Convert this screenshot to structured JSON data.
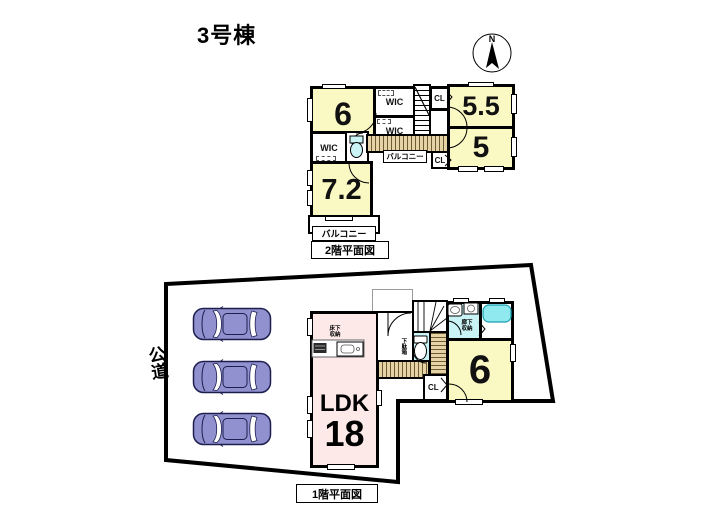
{
  "meta": {
    "title": "3号棟"
  },
  "compass": {
    "north_label": "N"
  },
  "colors": {
    "room-yellow": "#FBF9C3",
    "ldk-pink": "#FCE9E8",
    "water-cyan": "#C9F3F4",
    "tub-cyan": "#8FE9EF",
    "wood-light": "#E5D3A5",
    "wood-dark": "#6E5B33",
    "car-purple": "#9191CF"
  },
  "floor2": {
    "caption": "2階平面図",
    "rooms": {
      "bedroom_6": "6",
      "wic_top": "WIC",
      "wic_mid": "WIC",
      "closet_top": "CL",
      "bedroom_5_5": "5.5",
      "bedroom_5": "5",
      "wic_bottom": "WIC",
      "bedroom_7_2": "7.2",
      "closet_mid": "CL",
      "balcony_center": "バルコニー",
      "balcony_south": "バルコニー"
    }
  },
  "floor1": {
    "caption": "1階平面図",
    "road_label": "公道",
    "ldk_label": "LDK",
    "ldk_size": "18",
    "bedroom_6": "6",
    "closet": "CL",
    "hall_storage": "廊下収納",
    "underfloor_storage": "床下収納",
    "shoe_cabinet": "下駄箱",
    "parking": {
      "car_count": 3
    }
  }
}
